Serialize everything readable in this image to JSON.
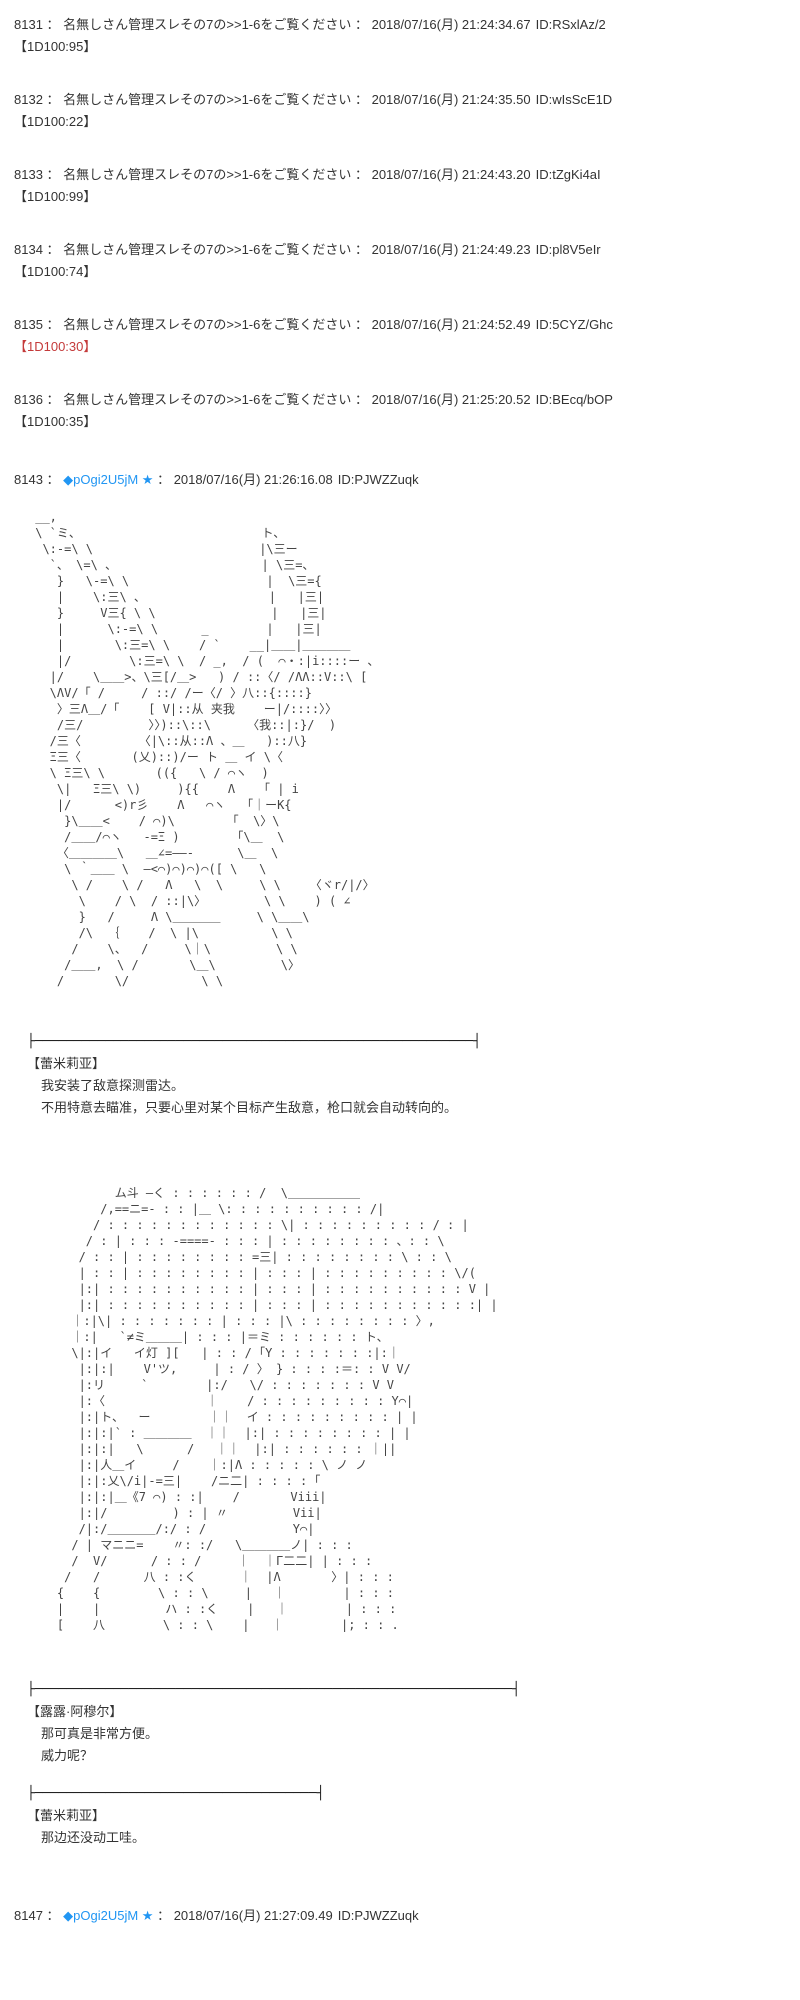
{
  "ui": {
    "sep": " ： "
  },
  "colors": {
    "trip_blue": "#2196f3",
    "dice_red": "#c43a3a",
    "text_dark": "#333333"
  },
  "anon_posts": [
    {
      "no": "8131",
      "name": "名無しさん管理スレその7の>>1-6をご覧ください",
      "date": "2018/07/16(月) 21:24:34.67",
      "id": "ID:RSxlAz/2",
      "dice": "【1D100:95】",
      "dice_color": "#333333"
    },
    {
      "no": "8132",
      "name": "名無しさん管理スレその7の>>1-6をご覧ください",
      "date": "2018/07/16(月) 21:24:35.50",
      "id": "ID:wIsScE1D",
      "dice": "【1D100:22】",
      "dice_color": "#333333"
    },
    {
      "no": "8133",
      "name": "名無しさん管理スレその7の>>1-6をご覧ください",
      "date": "2018/07/16(月) 21:24:43.20",
      "id": "ID:tZgKi4aI",
      "dice": "【1D100:99】",
      "dice_color": "#333333"
    },
    {
      "no": "8134",
      "name": "名無しさん管理スレその7の>>1-6をご覧ください",
      "date": "2018/07/16(月) 21:24:49.23",
      "id": "ID:pl8V5eIr",
      "dice": "【1D100:74】",
      "dice_color": "#333333"
    },
    {
      "no": "8135",
      "name": "名無しさん管理スレその7の>>1-6をご覧ください",
      "date": "2018/07/16(月) 21:24:52.49",
      "id": "ID:5CYZ/Ghc",
      "dice": "【1D100:30】",
      "dice_color": "#c43a3a"
    },
    {
      "no": "8136",
      "name": "名無しさん管理スレその7の>>1-6をご覧ください",
      "date": "2018/07/16(月) 21:25:20.52",
      "id": "ID:BEcq/bOP",
      "dice": "【1D100:35】",
      "dice_color": "#333333"
    }
  ],
  "trip_posts": [
    {
      "no": "8143",
      "trip": "◆pOgi2U5jM ★",
      "date": "2018/07/16(月) 21:26:16.08",
      "id": "ID:PJWZZuqk"
    },
    {
      "no": "8147",
      "trip": "◆pOgi2U5jM ★",
      "date": "2018/07/16(月) 21:27:09.49",
      "id": "ID:PJWZZuqk"
    }
  ],
  "aa1": [
    " __,",
    " \\ `ミ、                         ト、",
    "  \\:-=\\ \\                       |\\三ー",
    "   `、 \\=\\ 、                    | \\三=、",
    "    }   \\-=\\ \\                   |  \\三={",
    "    |    \\:三\\ 、                 |   |三|",
    "    }     V三{ \\ \\                |   |三|",
    "    |      \\:-=\\ \\      _        |   |三|",
    "    |       \\:三=\\ \\    / `    __|＿＿|＿＿＿＿",
    "    |/        \\:三=\\ \\  / _,  / (  ⌒・:|i::::ー 、",
    "   |/    \\＿＿>、\\三[/＿>   ) / ::〈/ /ΛΛ::V::\\ [",
    "   \\ΛV/「 /     / ::/ /ー〈/ 〉八::{::::}",
    "    〉三Λ＿/「    [ V|::从 夹我    ー|/::::〉〉",
    "    /三/         〉〉)::\\::\\     〈我::|:}/  )",
    "   /三〈        〈|\\::从::Λ 、＿   )::八}",
    "   Ξ三〈       (乂)::)/ー ト ＿ イ \\〈",
    "   \\ Ξ三\\ \\       (({   \\ / ⌒ヽ  )",
    "    \\|   Ξ三\\ \\)     ){{    Λ    ｢ | i",
    "    |/      <)r彡    Λ   ⌒ヽ   ｢｜ーK{",
    "     }\\＿＿<    / ⌒)\\        ｢  \\〉\\",
    "     /＿＿/⌒ヽ   -=Ξ )        ｢\\＿  \\",
    "    〈＿＿＿＿\\   ＿∠=――‐      \\＿  \\",
    "     \\ ｀＿＿ \\  ―<⌒)⌒)⌒)⌒([ \\   \\",
    "      \\ /    \\ /   Λ   \\  \\     \\ \\    〈ヾr/|/〉",
    "       \\    / \\  / ::|\\〉        \\ \\    ) ( ∠",
    "       }   /     Λ \\＿＿＿＿     \\ \\＿＿\\",
    "       /\\  ｛    /  \\ |\\          \\ \\",
    "      /    \\、  /     \\｜\\         \\ \\",
    "     /＿＿,  \\ /       \\＿\\         \\〉",
    "    /       \\/          \\ \\",
    "",
    ""
  ],
  "dialogue1": {
    "separator": "├────────────────────────────────────────────────────────┤",
    "speaker": "【蕾米莉亚】",
    "lines": [
      "我安装了敌意探测雷达。",
      "不用特意去瞄准，只要心里对某个目标产生敌意，枪口就会自动转向的。"
    ]
  },
  "aa2": [
    "            ム斗 ―く : : : : : : /  \\＿＿＿＿＿＿",
    "          /,==ニ=- : : |＿ \\: : : : : : : : : : /|",
    "         / : : : : : : : : : : : : \\| : : : : : : : : : / : |",
    "        / : | : : : -====- : : : | : : : : : : : : 、: : \\",
    "       / : : | : : : : : : : : =三| : : : : : : : : \\ : : \\",
    "       | : : | : : : : : : : : | : : : | : : : : : : : : : \\/(",
    "       |:| : : : : : : : : : : | : : : | : : : : : : : : : : V |",
    "       |:| : : : : : : : : : : | : : : | : : : : : : : : : : :| |",
    "      ｜:|\\| : : : : : : : | : : : |\\ : : : : : : : : 〉,",
    "      ｜:|   `≠ミ＿＿＿| : : : |＝ミ : : : : : : ト、",
    "      \\|:|イ   イ灯 ][   | : : / ｢Y : : : : : : :|:｜",
    "       |:|:|    V'ツ,     | : / 〉 } : : : :＝: : V V/",
    "       |:リ     `        |:/   \\/ : : : : : : : V V",
    "       |:〈              ｜    / : : : : : : : : : Y⌒|",
    "       |:|ト、  ー        ｜｜  イ : : : : : : : : : | |",
    "       |:|:|` : ＿＿＿＿  ｜｜  |:| : : : : : : : : | |",
    "       |:|:|   \\      /   ｜｜  |:| : : : : : : ｜||",
    "       |:|人＿イ     /    ｜:|Λ : : : : : \\ ノ ノ",
    "       |:|:乂\\/i|-=三|    /ニ二| : : : : ｢",
    "       |:|:|＿《7 ⌒) : :|    /       Viii|",
    "       |:|/         ) : | 〃         Vii|",
    "       /|:/＿＿＿＿/:/ : /            Y⌒|",
    "      / | マニニ=    〃: :/   \\＿＿＿＿ノ| : : :",
    "      /  V/      / : : /     ｜  ｜Γ二二| | : : :",
    "     /   /      八 : :く      ｜  |Λ       〉| : : :",
    "    {    {        \\ : : \\     |   ｜        | : : :",
    "    |    |         ハ : :く    |   ｜        | : : :",
    "    [    八        \\ : : \\    |   ｜        |; : : .",
    "",
    "",
    ""
  ],
  "dialogue2": {
    "separator": "├─────────────────────────────────────────────────────────────┤",
    "speaker": "【露露·阿穆尔】",
    "lines": [
      "那可真是非常方便。",
      "威力呢？"
    ]
  },
  "dialogue3": {
    "separator": "├────────────────────────────────────┤",
    "speaker": "【蕾米莉亚】",
    "lines": [
      "那边还没动工哇。"
    ]
  }
}
